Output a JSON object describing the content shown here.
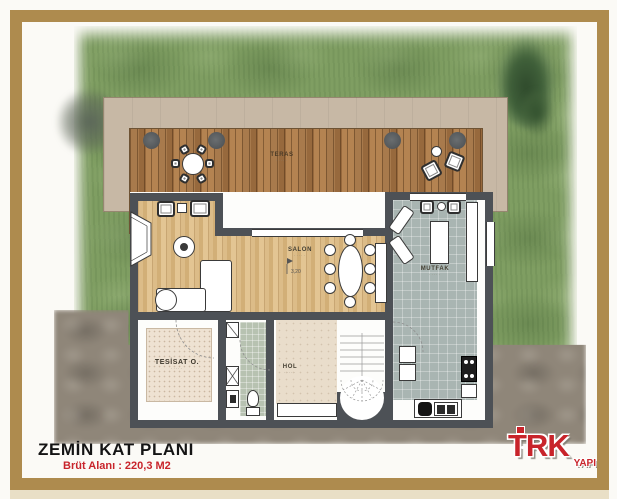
{
  "plan": {
    "rooms": {
      "teras": {
        "label": "TERAS",
        "area_text": "·····"
      },
      "salon": {
        "label": "SALON",
        "area_text": "·····"
      },
      "mutfak": {
        "label": "MUTFAK",
        "area_text": "·····"
      },
      "hol": {
        "label": "HOL",
        "area_text": "·····"
      },
      "tesisat": {
        "label": "TESİSAT O.",
        "area_text": "·····"
      }
    },
    "level_marker": "3,20"
  },
  "title_block": {
    "title": "ZEMİN KAT PLANI",
    "subtitle": "Brüt Alanı : 220,3 M2"
  },
  "logo": {
    "name": "TRK",
    "sub": "YAPI"
  },
  "colors": {
    "frame_gold": "#ae8b4e",
    "grass_green": "#7f9e62",
    "deck_wood": "#a87a4c",
    "wall_gray": "#4d5156",
    "accent_red": "#c8242b"
  }
}
